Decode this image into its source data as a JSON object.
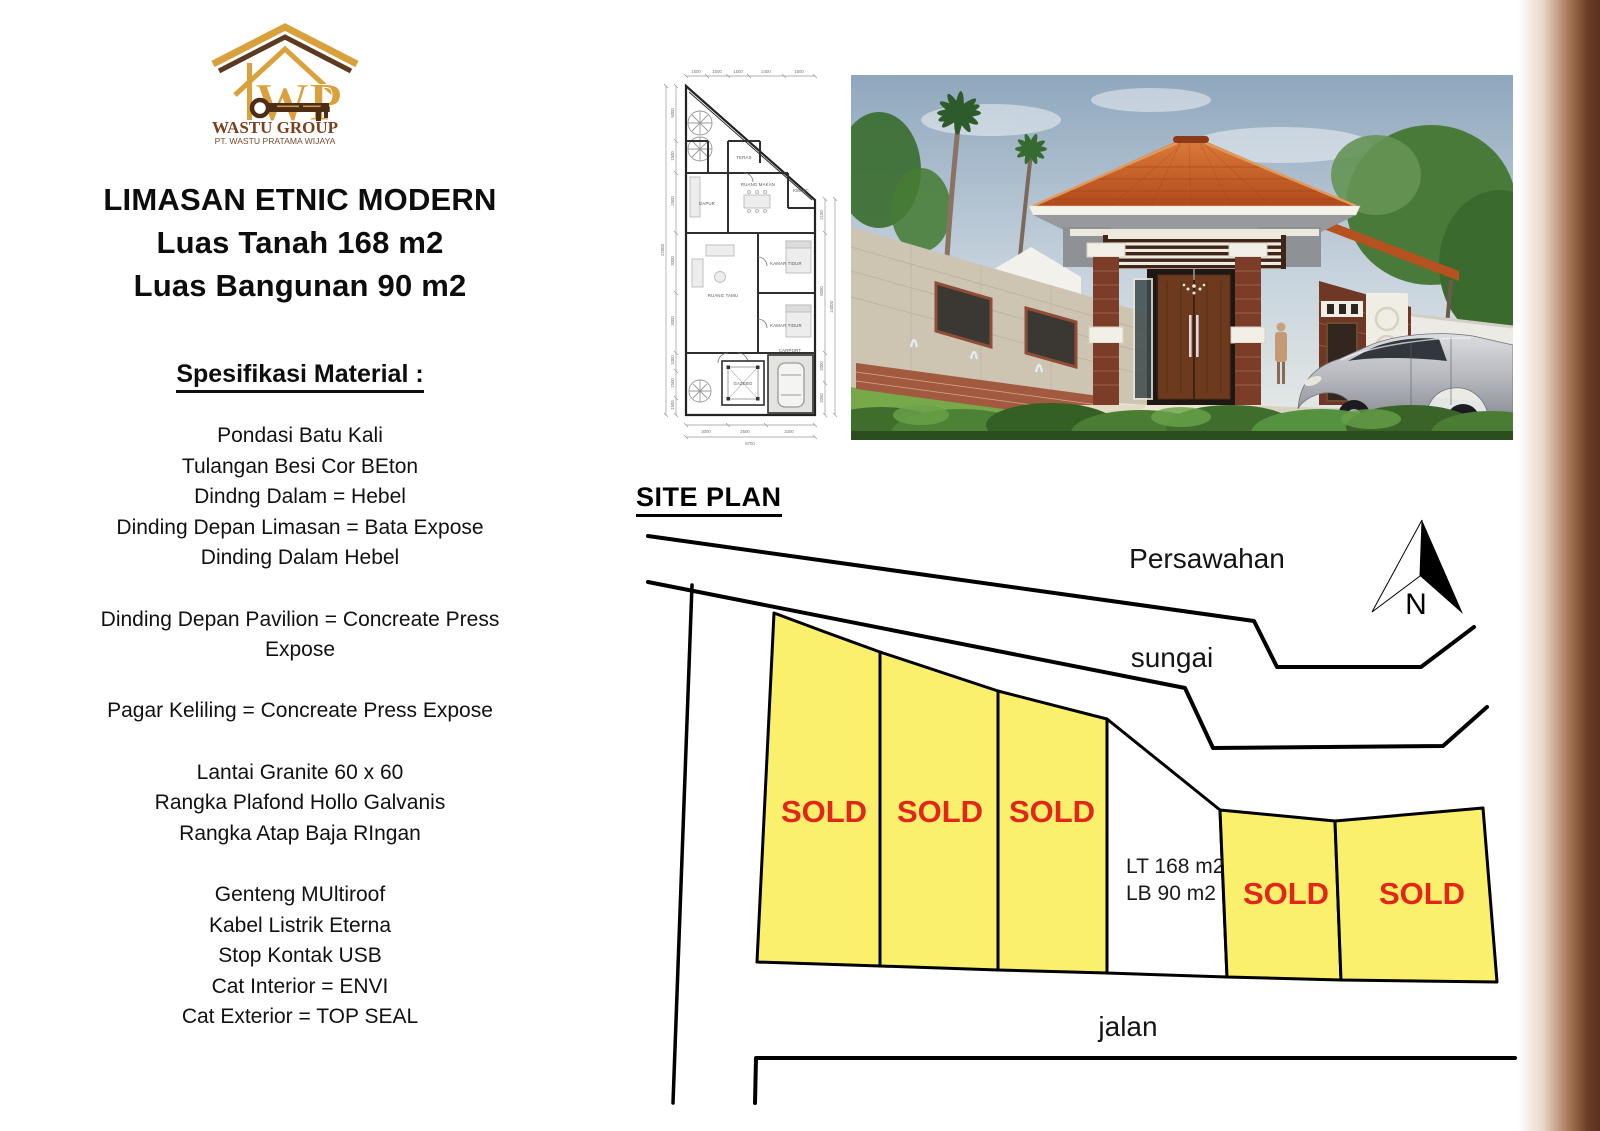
{
  "logo": {
    "wp": "WP",
    "brand": "WASTU GROUP",
    "company": "PT. WASTU PRATAMA WIJAYA"
  },
  "header": {
    "title": "LIMASAN ETNIC MODERN",
    "line2": "Luas Tanah 168 m2",
    "line3": "Luas Bangunan 90 m2"
  },
  "spec": {
    "heading": "Spesifikasi Material :",
    "lines": [
      "Pondasi Batu Kali",
      "Tulangan Besi Cor BEton",
      "Dindng Dalam = Hebel",
      "Dinding Depan Limasan = Bata Expose",
      "Dinding Dalam Hebel",
      "",
      "Dinding Depan Pavilion = Concreate Press",
      "Expose",
      "",
      "Pagar Keliling = Concreate Press Expose",
      "",
      "Lantai Granite 60 x 60",
      "Rangka Plafond Hollo Galvanis",
      "Rangka Atap Baja RIngan",
      "",
      "Genteng MUltiroof",
      "Kabel Listrik Eterna",
      "Stop Kontak USB",
      "Cat Interior = ENVI",
      "Cat Exterior  = TOP SEAL"
    ]
  },
  "floorplan": {
    "dims_top": [
      "1500",
      "1500",
      "1500",
      "2400",
      "1500"
    ],
    "dims_left": [
      "5000",
      "1500",
      "2500",
      "3000",
      "3000",
      "1000",
      "2500",
      "1500"
    ],
    "dim_left_total": "22000",
    "dims_right": [
      "2150",
      "8000",
      "2000",
      "2050"
    ],
    "dim_right_total": "14000",
    "dims_bottom": [
      "3000",
      "2500",
      "3200"
    ],
    "dim_bottom_total": "8700",
    "rooms": {
      "dapur": "DAPUR",
      "teras": "TERAS",
      "ruang_makan": "RUANG MAKAN",
      "km": "KM/WC",
      "ruang_tamu": "RUANG TAMU",
      "kamar_tidur1": "KAMAR TIDUR",
      "kamar_tidur2": "KAMAR TIDUR",
      "gazebo": "GAZEBO",
      "carport": "CARPORT"
    }
  },
  "siteplan": {
    "heading": "SITE PLAN",
    "labels": {
      "persawahan": "Persawahan",
      "sungai": "sungai",
      "jalan": "jalan",
      "north": "N"
    },
    "sold": "SOLD",
    "unsold": {
      "line1": "LT 168 m2",
      "line2": "LB  90 m2"
    }
  },
  "theme": {
    "lot_yellow": "#FAF06C",
    "sold_red": "#E2261B",
    "strip_brown": "#5A2F1C",
    "logo_gold": "#D9A13B",
    "logo_dark_brown": "#5B3A21",
    "brand_text": "#7B3F1B",
    "roof_orange": "#C85A28"
  }
}
